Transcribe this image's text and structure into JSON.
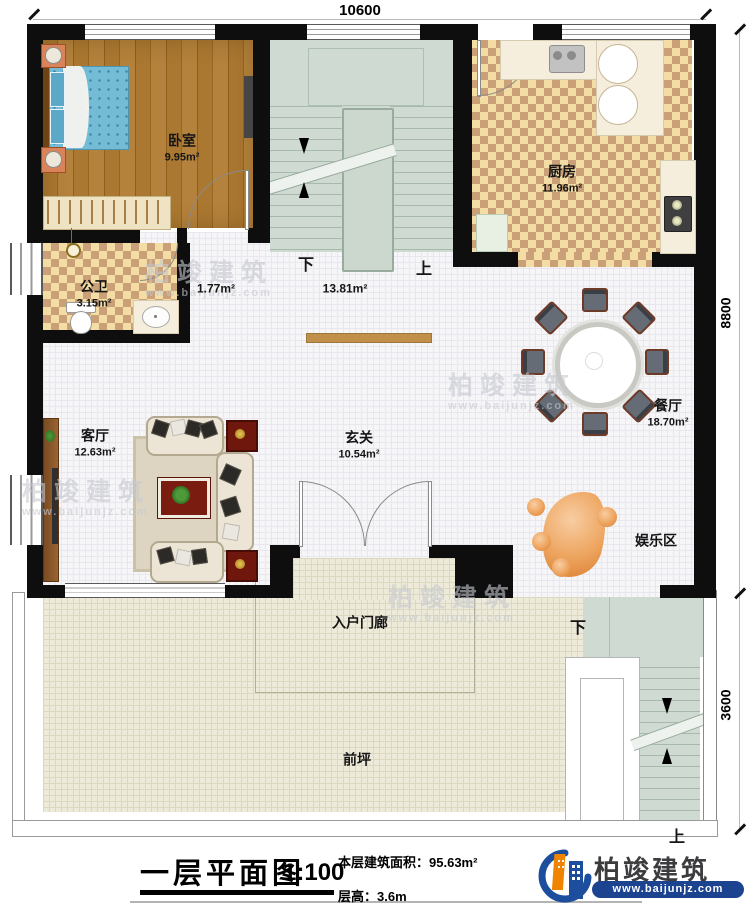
{
  "dims": {
    "width_top": "10600",
    "height_upper": "8800",
    "height_lower": "3600"
  },
  "rooms": [
    {
      "id": "bedroom",
      "name": "卧室",
      "area": "9.95m²"
    },
    {
      "id": "public-bath",
      "name": "公卫",
      "area": "3.15m²"
    },
    {
      "id": "kitchen",
      "name": "厨房",
      "area": "11.96m²"
    },
    {
      "id": "living-room",
      "name": "客厅",
      "area": "12.63m²"
    },
    {
      "id": "foyer",
      "name": "玄关",
      "area": "10.54m²"
    },
    {
      "id": "dining-room",
      "name": "餐厅",
      "area": "18.70m²"
    },
    {
      "id": "entertainment",
      "name": "娱乐区",
      "area": ""
    },
    {
      "id": "entry-porch",
      "name": "入户门廊",
      "area": ""
    },
    {
      "id": "front-yard",
      "name": "前坪",
      "area": ""
    }
  ],
  "stairwell": {
    "down_label": "下",
    "down_area": "1.77m²",
    "up_label": "上",
    "up_area": "13.81m²"
  },
  "exterior_stairs": {
    "down_label": "下",
    "up_label": "上"
  },
  "title_block": {
    "title": "一层平面图",
    "scale": "1:100",
    "area_label": "本层建筑面积：",
    "area_value": "95.63m²",
    "height_label": "层高：",
    "height_value": "3.6m"
  },
  "brand": {
    "name": "柏竣建筑",
    "url": "www.baijunjz.com"
  },
  "watermark": {
    "name": "柏竣建筑",
    "url": "www.baijunjz.com"
  },
  "colors": {
    "brand_blue": "#1c4e9d",
    "brand_orange": "#f08300",
    "wall": "#0e0e0e",
    "stair_green": "#cfdad2"
  }
}
